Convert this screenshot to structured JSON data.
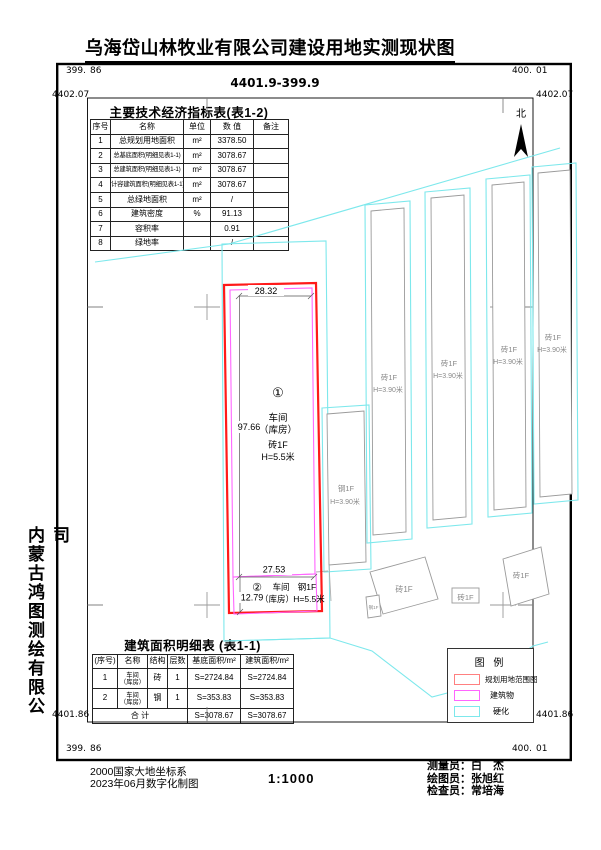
{
  "header": {
    "title": "乌海岱山林牧业有限公司建设用地实测现状图",
    "sheet_no": "4401.9-399.9"
  },
  "frame": {
    "x_left_int": "399.",
    "x_left_dec": "86",
    "x_right_int": "400.",
    "x_right_dec": "01",
    "y_top_left": "4402.07",
    "y_top_right": "4402.07",
    "y_bottom_left": "4401.86",
    "y_bottom_right": "4401.86",
    "north_label": "北"
  },
  "indicator_table": {
    "title": "主要技术经济指标表(表1-2)",
    "headers": [
      "序号",
      "名称",
      "单位",
      "数 值",
      "备注"
    ],
    "rows": [
      {
        "no": "1",
        "name": "总规划用地面积",
        "unit": "m²",
        "value": "3378.50",
        "note": ""
      },
      {
        "no": "2",
        "name": "总基底面积(明细见表1-1)",
        "unit": "m²",
        "value": "3078.67",
        "note": ""
      },
      {
        "no": "3",
        "name": "总建筑面积(明细见表1-1)",
        "unit": "m²",
        "value": "3078.67",
        "note": ""
      },
      {
        "no": "4",
        "name": "计容建筑面积(明细见表1-1)",
        "unit": "m²",
        "value": "3078.67",
        "note": ""
      },
      {
        "no": "5",
        "name": "总绿地面积",
        "unit": "m²",
        "value": "/",
        "note": ""
      },
      {
        "no": "6",
        "name": "建筑密度",
        "unit": "%",
        "value": "91.13",
        "note": ""
      },
      {
        "no": "7",
        "name": "容积率",
        "unit": "",
        "value": "0.91",
        "note": ""
      },
      {
        "no": "8",
        "name": "绿地率",
        "unit": "",
        "value": "/",
        "note": ""
      }
    ]
  },
  "area_table": {
    "title": "建筑面积明细表 (表1-1)",
    "headers": [
      "(序号)",
      "名称",
      "结构",
      "层数",
      "基底面积/m²",
      "建筑面积/m²"
    ],
    "rows": [
      {
        "no": "1",
        "name_l1": "车间",
        "name_l2": "（库房）",
        "struct": "砖",
        "floors": "1",
        "base_area": "S=2724.84",
        "floor_area": "S=2724.84"
      },
      {
        "no": "2",
        "name_l1": "车间",
        "name_l2": "（库房）",
        "struct": "钢",
        "floors": "1",
        "base_area": "S=353.83",
        "floor_area": "S=353.83"
      }
    ],
    "total_label": "合 计",
    "total_base_area": "S=3078.67",
    "total_floor_area": "S=3078.67"
  },
  "map": {
    "plot1": {
      "no": "①",
      "name": "车间",
      "name2": "（库房）",
      "structure": "砖1F",
      "height": "H=5.5米",
      "dim_width": "28.32",
      "dim_height": "97.66"
    },
    "plot2": {
      "no": "②",
      "name": "车间",
      "name2": "（库房）",
      "structure": "钢1F",
      "height": "H=5.5米",
      "dim_width": "27.53",
      "dim_height": "12.79"
    },
    "neighbors": {
      "strip1": {
        "label": "砖1F",
        "height": "H=3.90米"
      },
      "strip2": {
        "label": "砖1F",
        "height": "H=3.90米"
      },
      "strip3": {
        "label": "砖1F",
        "height": "H=3.90米"
      },
      "strip4": {
        "label": "砖1F",
        "height": "H=3.90米"
      },
      "steel": {
        "label": "钢1F",
        "height": "H=3.90米"
      },
      "square": {
        "label": "砖1F"
      },
      "small_box": {
        "label": "砖1F"
      },
      "right_quad": {
        "label": "砖1F"
      },
      "tiny": {
        "label": "钢1F"
      }
    }
  },
  "legend": {
    "title": "图 例",
    "items": [
      {
        "label": "规划用地范围图",
        "color": "#ff8080"
      },
      {
        "label": "建筑物",
        "color": "#ff66ff"
      },
      {
        "label": "硬化",
        "color": "#7de8ec"
      }
    ]
  },
  "footer": {
    "datum": "2000国家大地坐标系",
    "digitized": "2023年06月数字化制图",
    "scale": "1:1000",
    "staff": [
      {
        "label": "测量员：",
        "name": "白　杰"
      },
      {
        "label": "绘图员：",
        "name": "张旭红"
      },
      {
        "label": "检查员：",
        "name": "常培海"
      }
    ]
  },
  "company": "内蒙古鸿图测绘有限公司",
  "colors": {
    "boundary_red": "#ff1a1a",
    "building_magenta": "#ff66ff",
    "hardened_cyan": "#7de8ec",
    "neighbor_gray": "#9a9a9a"
  }
}
